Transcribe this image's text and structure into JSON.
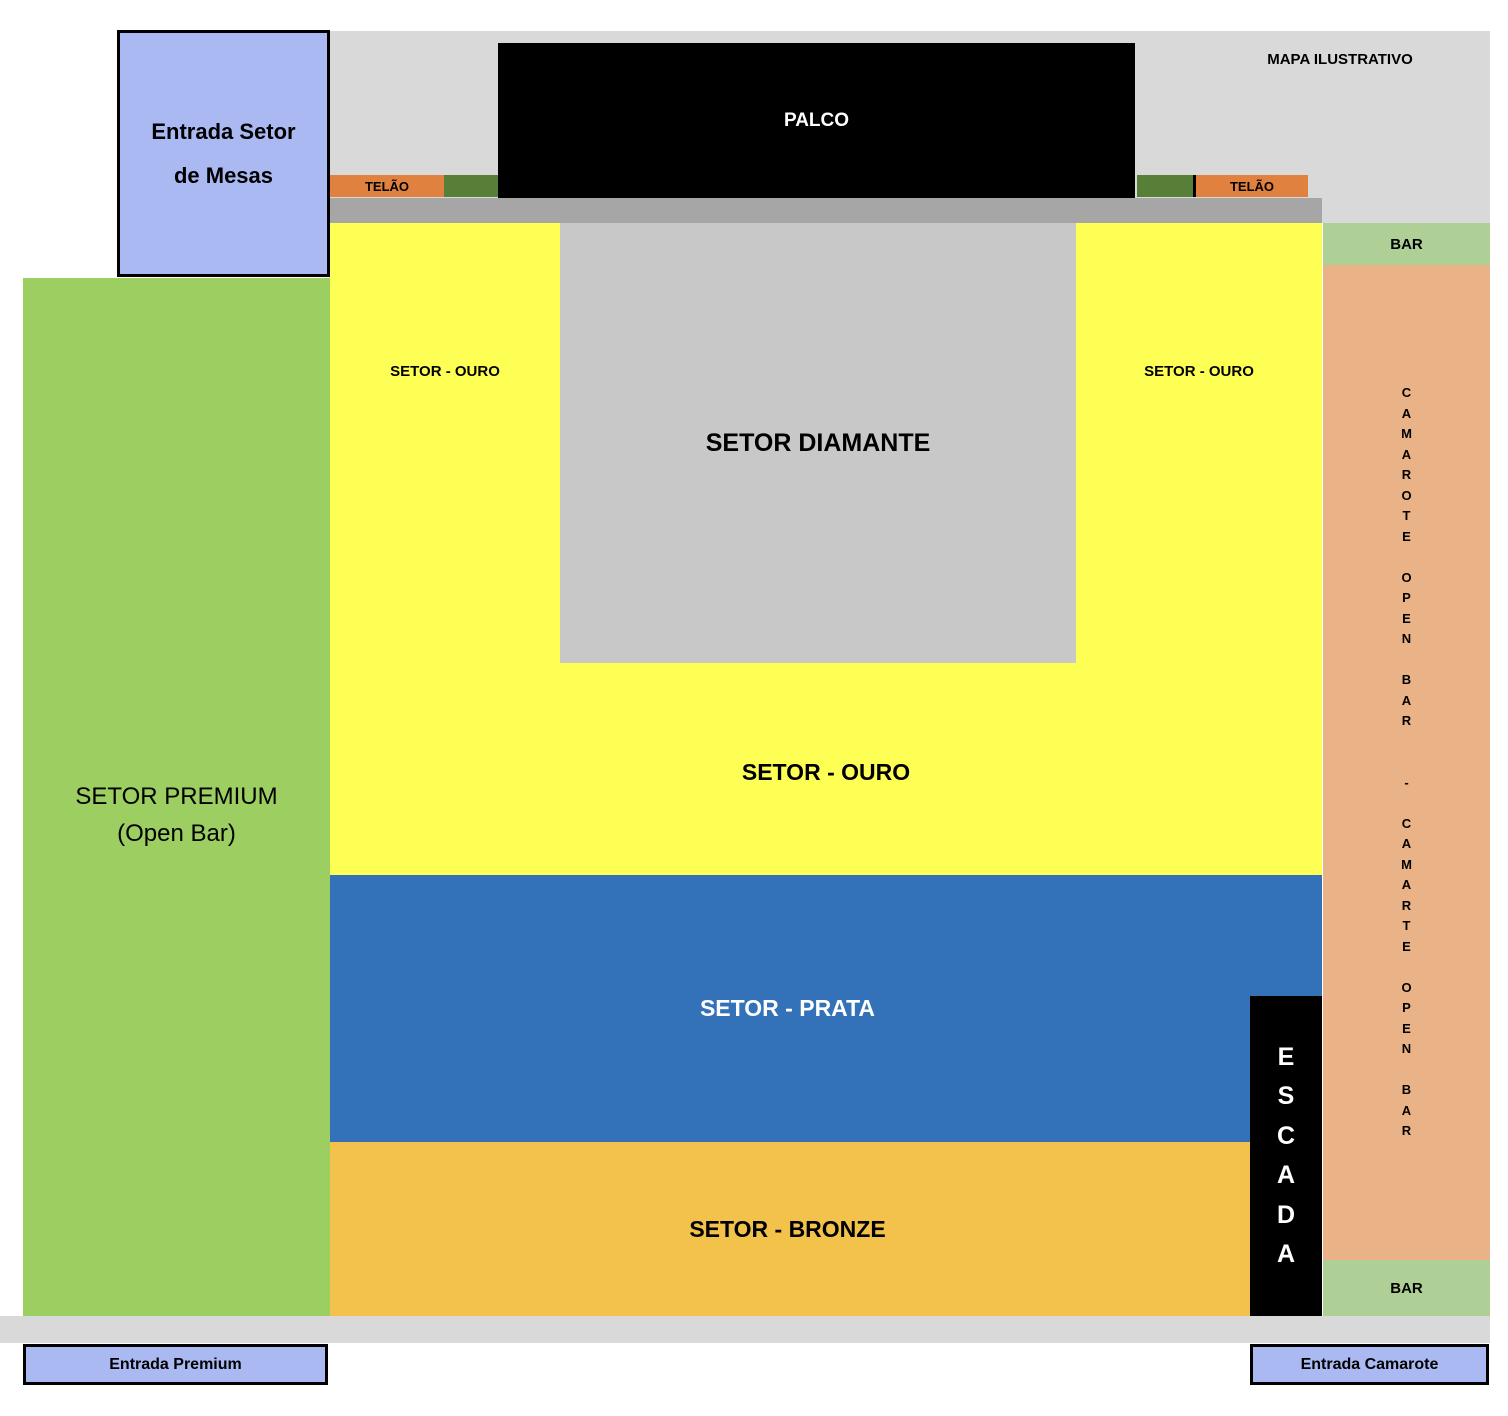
{
  "map": {
    "title": "MAPA ILUSTRATIVO",
    "stage_label": "PALCO",
    "screen_left_label": "TELÃO",
    "screen_right_label": "TELÃO",
    "sector_premium": "SETOR PREMIUM\n(Open Bar)",
    "sector_ouro_left": "SETOR - OURO",
    "sector_ouro_right": "SETOR - OURO",
    "sector_ouro_main": "SETOR - OURO",
    "sector_diamante": "SETOR DIAMANTE",
    "sector_prata": "SETOR - PRATA",
    "sector_bronze": "SETOR - BRONZE",
    "bar_top": "BAR",
    "bar_bottom": "BAR",
    "escada_text": "ESCADA",
    "escada_vertical": "E\nS\nC\nA\nD\nA",
    "camarote_text": "CAMAROTE OPEN BAR - CAMARTE OPEN BAR",
    "camarote_vertical": "C\nA\nM\nA\nR\nO\nT\nE\n\nO\nP\nE\nN\n\nB\nA\nR\n\n\n-\n\nC\nA\nM\nA\nR\nT\nE\n\nO\nP\nE\nN\n\nB\nA\nR",
    "entrance_tables": "Entrada Setor\nde Mesas",
    "entrance_premium": "Entrada Premium",
    "entrance_camarote": "Entrada Camarote"
  },
  "colors": {
    "stage_black": "#000000",
    "background_gray": "#d9d9d9",
    "walkway_gray": "#a6a6a6",
    "diamante_gray": "#c8c8c8",
    "ouro_yellow": "#feff55",
    "prata_blue": "#3371b8",
    "bronze_gold": "#f2c24b",
    "premium_green": "#9cce62",
    "camarote_salmon": "#e9b287",
    "bar_green": "#aecf96",
    "telao_orange": "#e0813f",
    "panel_dark_green": "#587f38",
    "entrance_blue": "#aab9f2"
  }
}
